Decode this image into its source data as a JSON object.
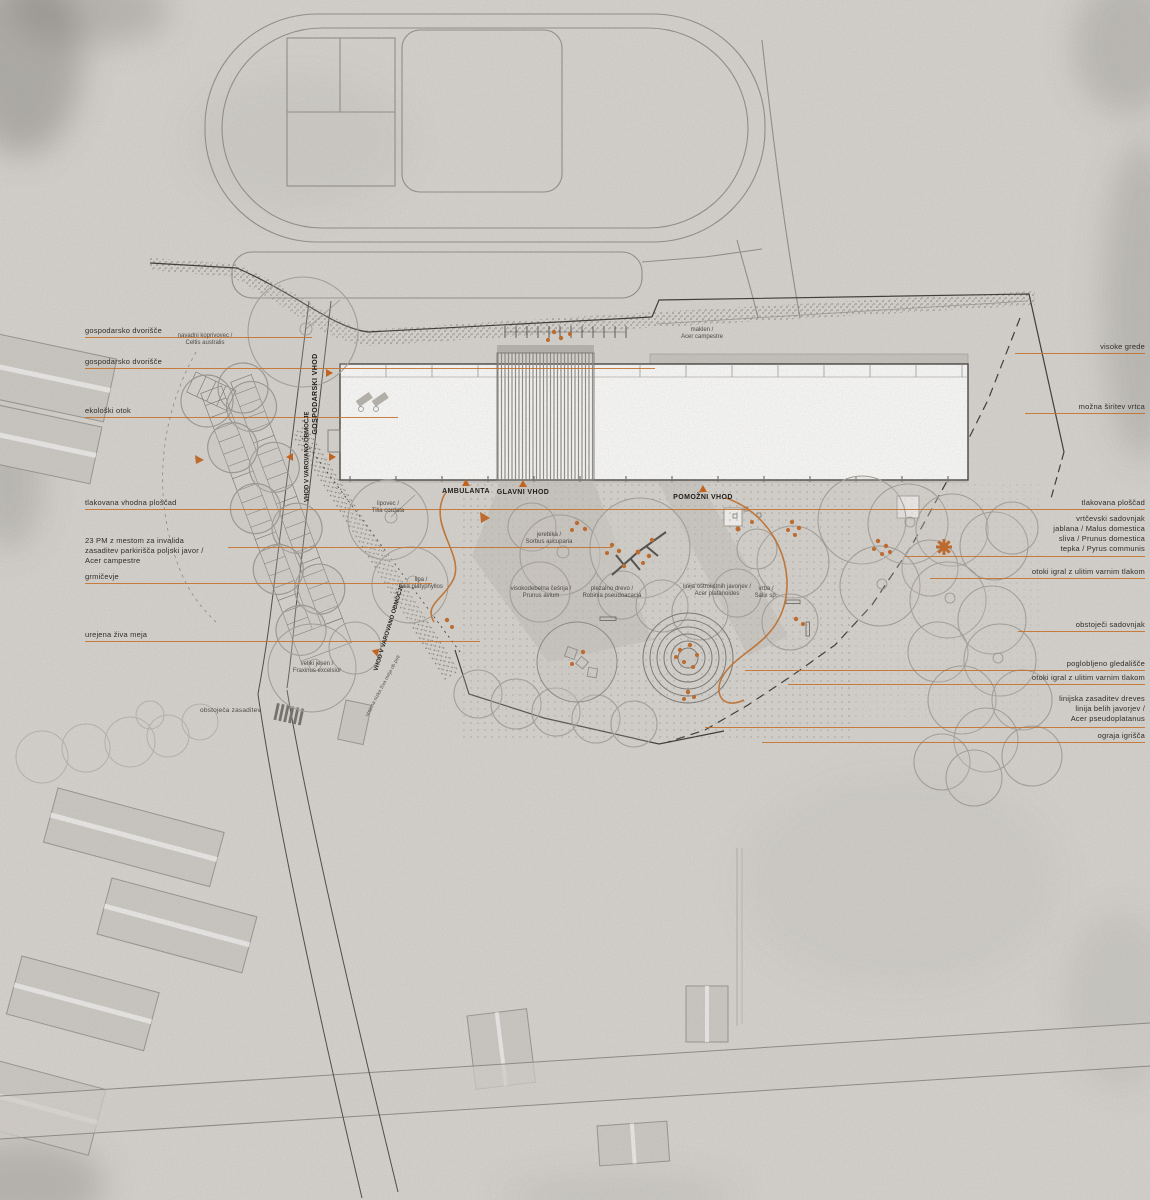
{
  "colors": {
    "accent_orange": "#c3722e",
    "triangle_orange": "#c2641f",
    "ink": "#2f2d2a",
    "paper": "#d8d5d0"
  },
  "labels": {
    "left": [
      {
        "text": "gospodarsko dvorišče"
      },
      {
        "text": "gospodarsko dvorišče"
      },
      {
        "text": "ekološki otok"
      },
      {
        "text": "tlakovana vhodna ploščad"
      },
      {
        "lines": [
          "23 PM z mestom za invalida",
          "zasaditev parkirišča poljski javor /",
          "Acer campestre"
        ]
      },
      {
        "text": "grmičevje"
      },
      {
        "text": "urejena živa meja"
      },
      {
        "text": "obstoječa zasaditev"
      }
    ],
    "right": [
      {
        "text": "visoke grede"
      },
      {
        "text": "možna širitev vrtca"
      },
      {
        "text": "tlakovana ploščad"
      },
      {
        "lines": [
          "vrtčevski sadovnjak",
          "jablana / Malus domestica",
          "sliva / Prunus domestica",
          "tepka / Pyrus communis"
        ]
      },
      {
        "text": "otoki igral z ulitim varnim tlakom"
      },
      {
        "text": "obstoječi sadovnjak"
      },
      {
        "text": "poglobljeno gledališče"
      },
      {
        "text": "otoki igral z ulitim varnim tlakom"
      },
      {
        "lines": [
          "linijska zasaditev dreves",
          "linija belih javorjev /",
          "Acer pseudoplatanus"
        ]
      },
      {
        "text": "ograja igrišča"
      }
    ],
    "entrances": {
      "ambulanta": "AMBULANTA",
      "glavni_vhod": "GLAVNI VHOD",
      "pomozni_vhod": "POMOŽNI VHOD",
      "gospodarski_vhod": "GOSPODARSKI VHOD",
      "varovano_1": "VHOD V VAROVANO OBMOČJE",
      "varovano_2": "VHOD V VAROVANO OBMOČJE"
    },
    "trees": [
      {
        "l1": "navadni koprivovec /",
        "l2": "Celtis australis"
      },
      {
        "l1": "maklen /",
        "l2": "Acer campestre"
      },
      {
        "l1": "lipovec /",
        "l2": "Tilia cordata"
      },
      {
        "l1": "lipa /",
        "l2": "Tilia platyphyllos"
      },
      {
        "l1": "jerebika /",
        "l2": "Sorbus aucuparia"
      },
      {
        "l1": "visokodebelna češnja /",
        "l2": "Prunus avium"
      },
      {
        "l1": "plezalno drevo /",
        "l2": "Robinia pseudoacacia"
      },
      {
        "l1": "linija ostrolistnih javorjev /",
        "l2": "Acer platanoides"
      },
      {
        "l1": "vrba /",
        "l2": "Salix sp."
      },
      {
        "l1": "veliki jesen /",
        "l2": "Fraxinus excelsior"
      }
    ],
    "path_note": "urejena nizka živa meja ob poti"
  }
}
